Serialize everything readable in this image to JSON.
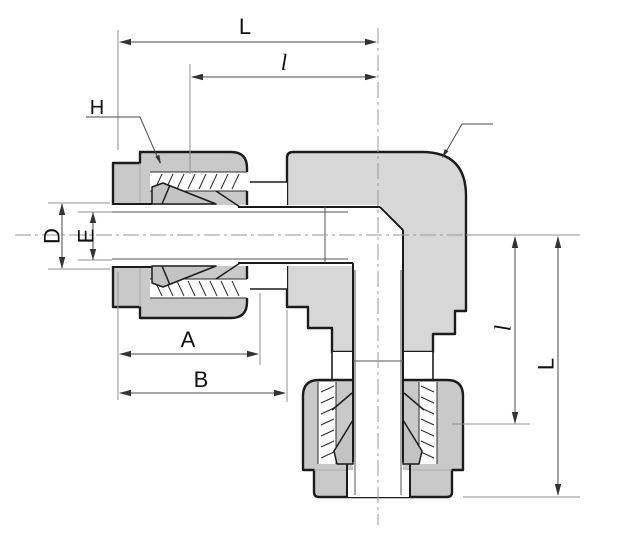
{
  "drawing": {
    "title": "90-degree elbow compression tube fitting - sectional dimension drawing",
    "labels": {
      "dim_L_top": "L",
      "dim_l_top": "l",
      "part_nut": "H",
      "part_body": "h",
      "dim_D": "D",
      "dim_E": "E",
      "dim_A": "A",
      "dim_B": "B",
      "dim_l_right": "l",
      "dim_L_right": "L"
    },
    "colors": {
      "background": "#ffffff",
      "body_fill": "#d7d7d7",
      "nut_fill": "#c9c9c9",
      "ferrule_fill": "#c3c3c3",
      "outline": "#1c1c1c",
      "dimension_line": "#4a4a4a",
      "extension_line": "#909090",
      "centerline": "#9a9a9a"
    }
  }
}
